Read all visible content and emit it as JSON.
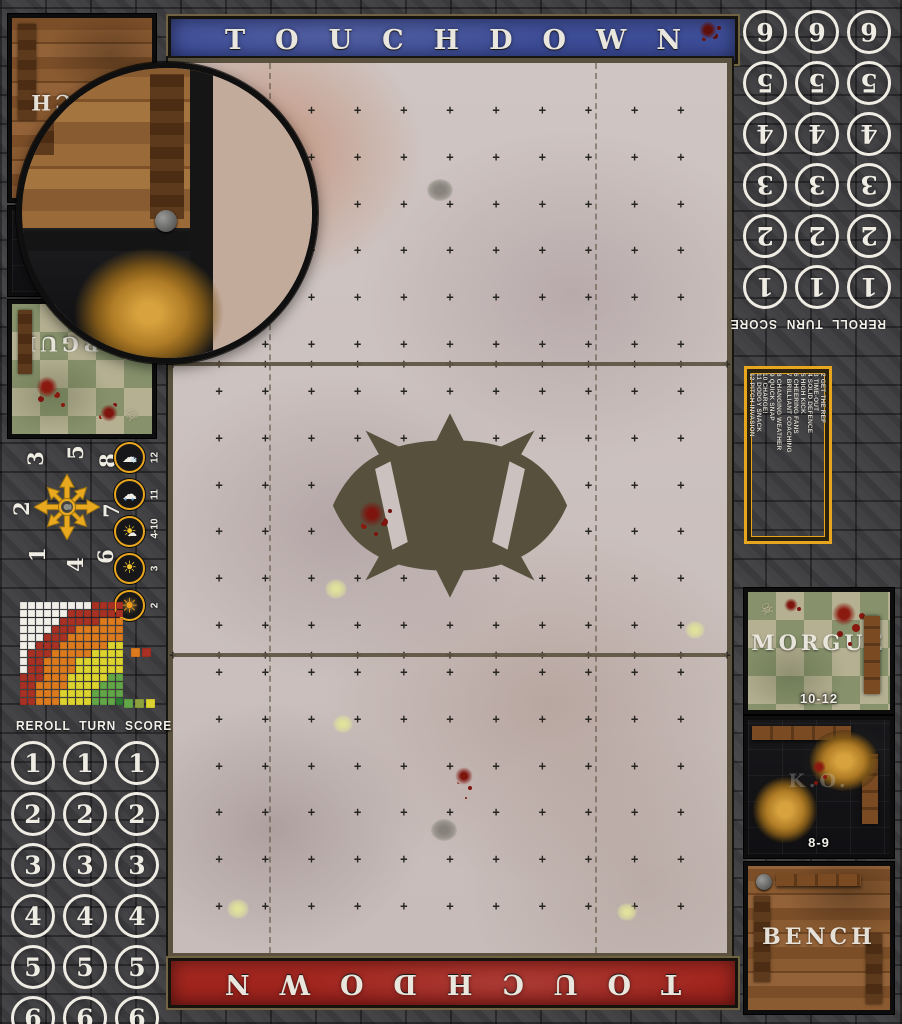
{
  "banners": {
    "top_label": "TOUCHDOWN",
    "bottom_label": "TOUCHDOWN"
  },
  "colors": {
    "banner_blue": "#3d4b97",
    "banner_red": "#a5231d",
    "accent_yellow": "#e8a51e",
    "field_frame": "#5a523f",
    "ball_logo": "#57503d"
  },
  "turn_track": {
    "header": "REROLL TURN SCORE",
    "columns": [
      "REROLL",
      "TURN",
      "SCORE"
    ],
    "numbers": [
      "1",
      "2",
      "3",
      "4",
      "5",
      "6"
    ]
  },
  "weather_track": {
    "items": [
      {
        "value": "12",
        "icon": "snow-cloud-icon"
      },
      {
        "value": "11",
        "icon": "rain-cloud-icon"
      },
      {
        "value": "4-10",
        "icon": "sun-behind-cloud-icon"
      },
      {
        "value": "3",
        "icon": "sun-icon"
      },
      {
        "value": "2",
        "icon": "blazing-sun-icon"
      }
    ]
  },
  "throw_in": {
    "numbers": [
      {
        "pos": "top-left",
        "n": "3"
      },
      {
        "pos": "top",
        "n": "5"
      },
      {
        "pos": "top-right",
        "n": "8"
      },
      {
        "pos": "left",
        "n": "2"
      },
      {
        "pos": "right",
        "n": "7"
      },
      {
        "pos": "bottom-left",
        "n": "1"
      },
      {
        "pos": "bottom",
        "n": "4"
      },
      {
        "pos": "bottom-right",
        "n": "6"
      }
    ]
  },
  "pass_chart": {
    "grid_size": 13,
    "bands": [
      {
        "name": "quick-pass",
        "color": "#63a647",
        "max": 3.45
      },
      {
        "name": "short-pass",
        "color": "#ddd32e",
        "max": 7.2
      },
      {
        "name": "long-pass",
        "color": "#dd7a1c",
        "max": 10.4
      },
      {
        "name": "long-bomb",
        "color": "#a93123",
        "max": 12.6
      },
      {
        "name": "out-of-range",
        "color": "#f2efe9",
        "max": 999
      }
    ],
    "origin_color": "#2e7d32",
    "legend_top": [
      "#dd7a1c",
      "#a93123"
    ],
    "legend_bottom": [
      "#63a647",
      "#8da23c",
      "#ddd32e"
    ]
  },
  "kickoff_table": {
    "column_a": [
      "2 GET THE REF",
      "3 TIME-OUT",
      "4 SOLID DEFENCE",
      "5 HIGH KICK",
      "6 CHEERING FANS",
      "7 BRILLIANT COACHING"
    ],
    "column_b": [
      "8 CHANGING WEATHER",
      "9 QUICK SNAP",
      "10 CHARGE!",
      "11 DODGY SNACK",
      "12 PITCH INVASION"
    ]
  },
  "dugouts": {
    "bench_label": "BENCH",
    "ko_label": "K.O.",
    "morgue_label": "MORGUE",
    "ko_range": "8-9",
    "morgue_range": "10-12"
  },
  "field": {
    "cols": 12,
    "rows": 19,
    "cross_glyph": "+",
    "solid_line_fractions": [
      0.338,
      0.665
    ],
    "dashed_line_fractions": [
      0.173,
      0.761
    ]
  }
}
